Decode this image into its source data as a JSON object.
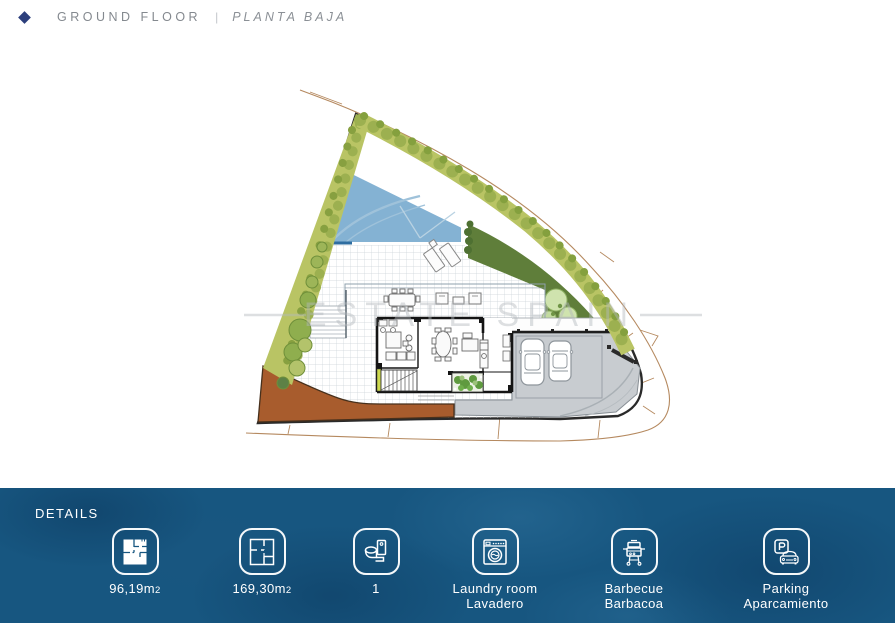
{
  "header": {
    "title_en": "GROUND FLOOR",
    "separator": "|",
    "title_es": "PLANTA BAJA"
  },
  "plan": {
    "watermark": "ESTATE SPAIN",
    "colors": {
      "pool": "#84b2d3",
      "hedge": "#b9c464",
      "lawn": "#5f7e3a",
      "terracotta": "#a85c2d",
      "driveway": "#c8ccd0",
      "road_line": "#b5895f"
    }
  },
  "details": {
    "label": "DETAILS",
    "band_color": "#175680",
    "items": [
      {
        "name": "built-area",
        "icon": "floorplan-filled-icon",
        "line1": "96,19m",
        "sub": "2",
        "line2": ""
      },
      {
        "name": "plot-area",
        "icon": "floorplan-outline-icon",
        "line1": "169,30m",
        "sub": "2",
        "line2": ""
      },
      {
        "name": "bathrooms",
        "icon": "toilet-icon",
        "line1": "1",
        "sub": "",
        "line2": ""
      },
      {
        "name": "laundry",
        "icon": "washing-machine-icon",
        "line1": "Laundry room",
        "sub": "",
        "line2": "Lavadero"
      },
      {
        "name": "barbecue",
        "icon": "barbecue-icon",
        "line1": "Barbecue",
        "sub": "",
        "line2": "Barbacoa"
      },
      {
        "name": "parking",
        "icon": "parking-icon",
        "line1": "Parking",
        "sub": "",
        "line2": "Aparcamiento"
      }
    ]
  }
}
